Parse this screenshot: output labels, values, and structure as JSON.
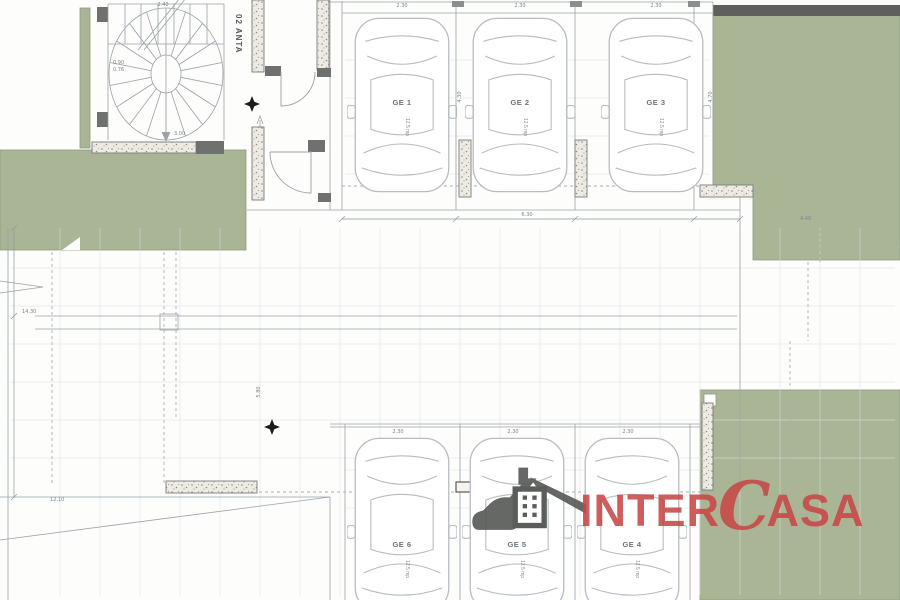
{
  "title": "Garage level floor plan",
  "colors": {
    "grass": "#a9b595",
    "grass_dark_strip": "#5d605b",
    "wall": "#6e716e",
    "logo_red": "#c84747",
    "line": "#9aa2a8"
  },
  "room": {
    "label": "02 ANTA"
  },
  "stair": {
    "run_dim": "2.40",
    "riser_a": "0.90",
    "riser_b": "0.76",
    "width_dim": "3.00"
  },
  "parking": {
    "top": [
      {
        "id": "GE 1",
        "width": "2.30",
        "area": "12.5 mp"
      },
      {
        "id": "GE 2",
        "width": "2.30",
        "area": "12.5 mp"
      },
      {
        "id": "GE 3",
        "width": "2.30",
        "area": "12.5 mp"
      }
    ],
    "bottom": [
      {
        "id": "GE 6",
        "width": "2.30",
        "area": "12.5 mp"
      },
      {
        "id": "GE 5",
        "width": "2.30",
        "area": "12.5 mp"
      },
      {
        "id": "GE 4",
        "width": "2.30",
        "area": "12.5 mp"
      }
    ]
  },
  "dims": {
    "aisle": "6.30",
    "bay_depth": "4.30",
    "right_depth": "4.70",
    "left_height": "14.30",
    "ramp": "12.10",
    "right_offset": "4.40",
    "mid_vertical": "5.80"
  },
  "logo": {
    "inter": "INTER",
    "c": "C",
    "asa": "ASA"
  }
}
